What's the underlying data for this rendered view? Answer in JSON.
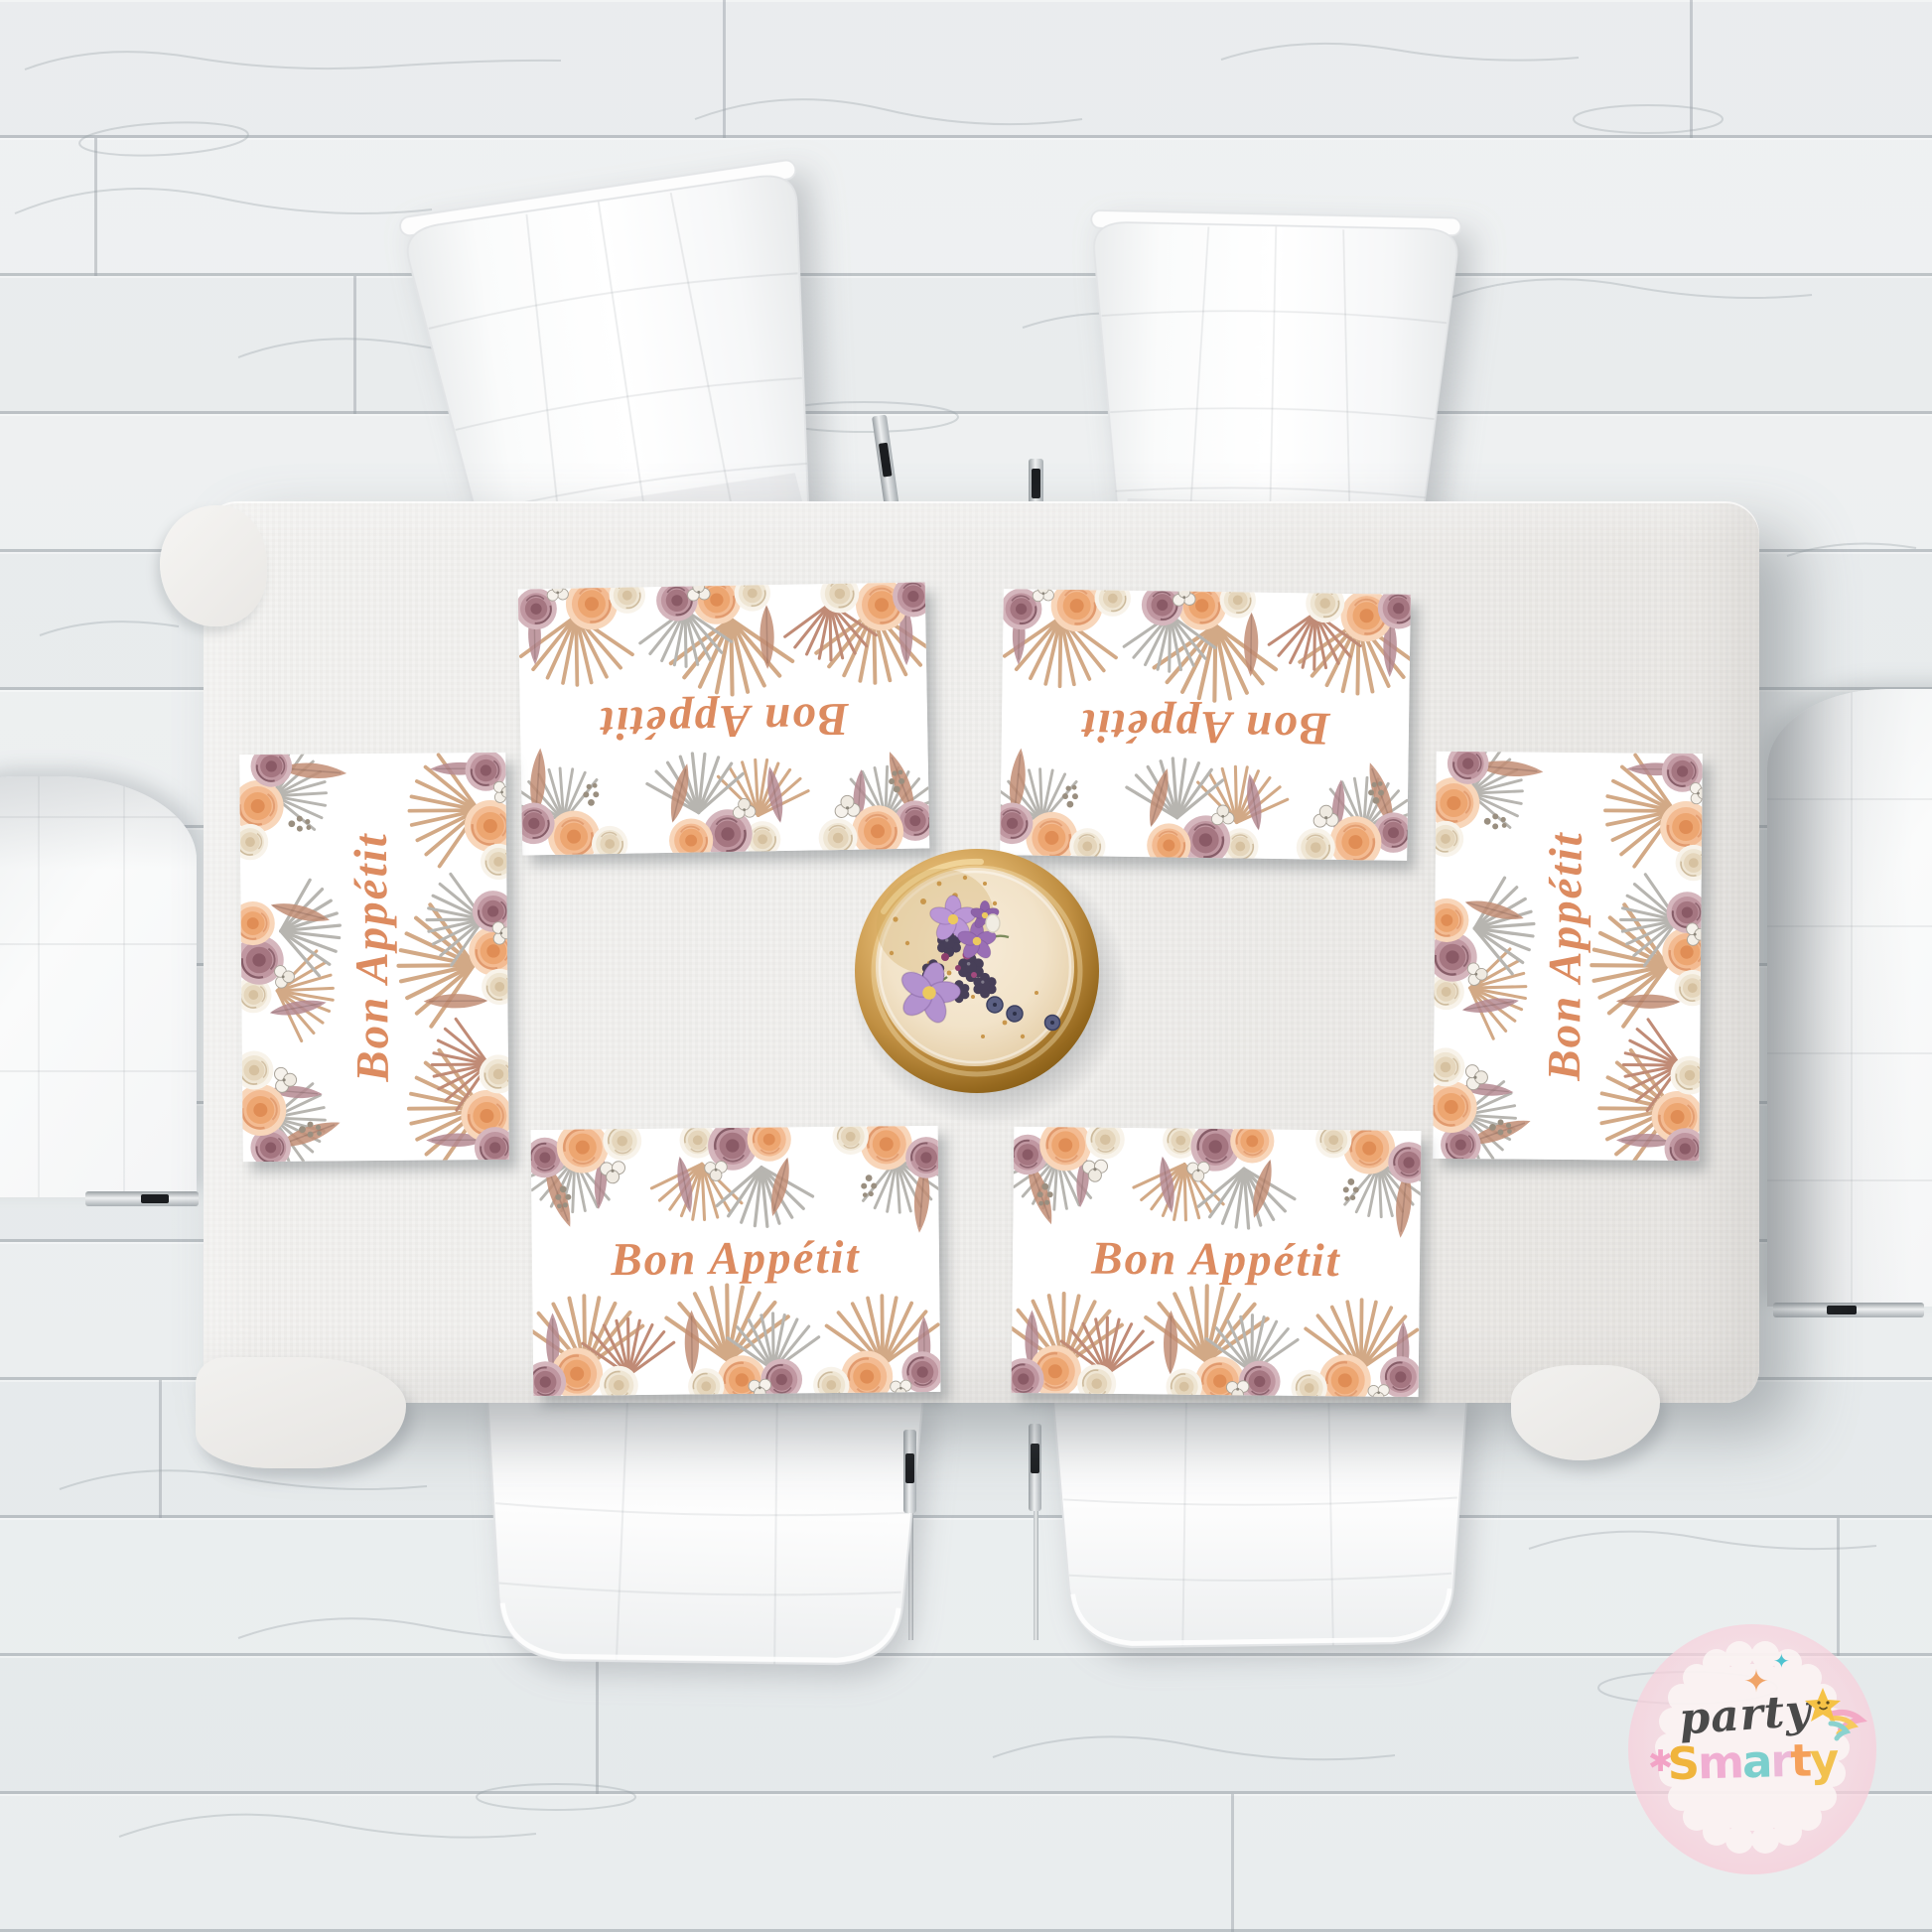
{
  "placemats": {
    "label": "Bon Appétit",
    "count": 6,
    "text_color": "#dc8b60",
    "positions": [
      "top-left",
      "top-right",
      "left",
      "right",
      "bottom-left",
      "bottom-right"
    ],
    "orientations_deg": [
      179,
      181,
      -90,
      -90,
      0,
      0
    ],
    "floral_palette": [
      "#f3bb92",
      "#efe6d4",
      "#c097a1",
      "#d2a986",
      "#b7b5b0",
      "#c28d74",
      "#b58a92"
    ]
  },
  "table": {
    "cloth_color": "#f0efed"
  },
  "floor": {
    "plank_color": "#edf0f1",
    "seam_color": "#96a0a6"
  },
  "cake": {
    "plate_color": "#c08f42",
    "frosting_color": "#f2e3c9",
    "topping_colors": [
      "#bb97d6",
      "#9a6fb5",
      "#473f58",
      "#5b6083",
      "#a34a7e",
      "#c9974c"
    ]
  },
  "watermark": {
    "script_word": "party",
    "brand_word": "Smarty",
    "circle_color": "#f7cdd9",
    "badge_color": "#fcf8f6",
    "script_color": "#4a4a4a",
    "letters": [
      {
        "ch": "S",
        "color": "#f0b43c"
      },
      {
        "ch": "m",
        "color": "#f0aed2"
      },
      {
        "ch": "a",
        "color": "#7ccfcd"
      },
      {
        "ch": "r",
        "color": "#ecb9d8"
      },
      {
        "ch": "t",
        "color": "#f5a05a"
      },
      {
        "ch": "y",
        "color": "#f2c14e"
      }
    ],
    "icons": [
      "sparkle-icon",
      "asterisk-sparkle-icon",
      "shooting-star-icon"
    ],
    "sparkle_colors": {
      "teal": "#4ec3d0",
      "peach": "#f0a468",
      "pink": "#f2a3c6"
    }
  }
}
